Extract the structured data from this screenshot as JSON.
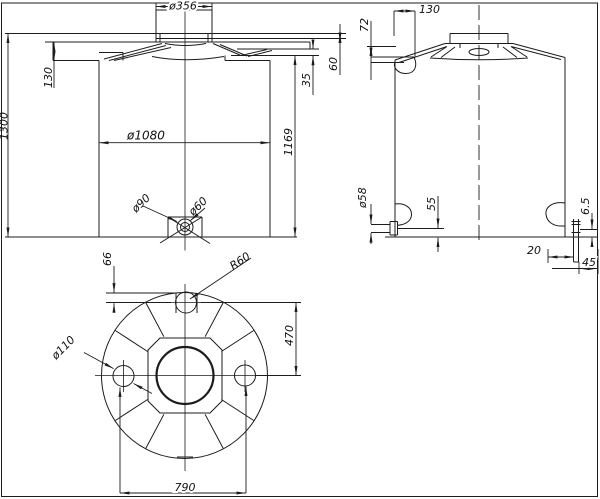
{
  "colors": {
    "background": "#ffffff",
    "line": "#1c1c1c"
  },
  "views": {
    "front": {
      "title": "front-view",
      "dims": {
        "dia356": "ø356",
        "h1300": "1300",
        "d130": "130",
        "dia1080": "ø1080",
        "h1169": "1169",
        "d35": "35",
        "d60": "60",
        "dia90": "ø90",
        "dia60": "ø60"
      }
    },
    "side": {
      "title": "side-view",
      "dims": {
        "d130": "130",
        "d72": "72",
        "dia58": "ø58",
        "d55": "55",
        "d65": "6.5",
        "d20": "20",
        "d45": "45"
      }
    },
    "bottom": {
      "title": "bottom-view",
      "dims": {
        "d66": "66",
        "r60": "R60",
        "dia110": "ø110",
        "d470": "470",
        "d790": "790"
      }
    }
  }
}
